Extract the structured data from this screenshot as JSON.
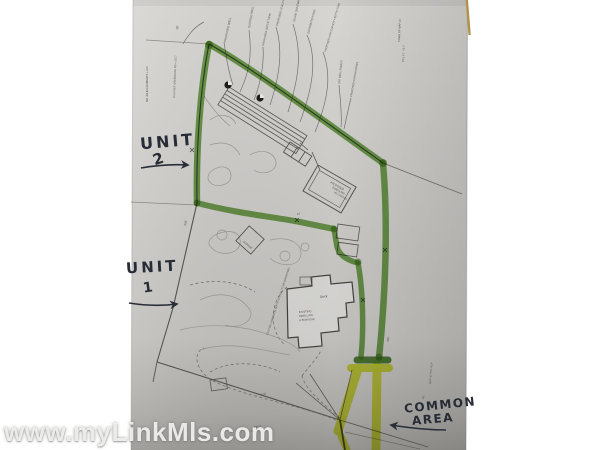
{
  "watermark": {
    "text": "www.myLinkMls.com"
  },
  "annotations": {
    "unit2": {
      "word": "UNIT",
      "number": "2"
    },
    "unit1": {
      "word": "UNIT",
      "number": "1"
    },
    "common": {
      "line1": "COMMON",
      "line2": "AREA"
    }
  },
  "colors": {
    "highlight_green": "#5f9e33",
    "highlight_yellow": "#dde93d",
    "paper": "#c9c8c5",
    "handwriting_ink": "#262b35",
    "survey_line": "#55534f",
    "paper_edge_gold": "#b2924a"
  },
  "map_labels": [
    {
      "t": "10'",
      "x": 178,
      "y": 30,
      "r": -80,
      "s": 3.2
    },
    {
      "t": "N/F JOHN A ROBERTS + CO",
      "x": 148,
      "y": 102,
      "r": -90,
      "s": 2.7
    },
    {
      "t": "PLAN REF. GREENBUSH RD = 133.7",
      "x": 175,
      "y": 98,
      "r": -88,
      "s": 2.5
    },
    {
      "t": "PROPOSED WELL",
      "x": 226,
      "y": 42,
      "r": -78,
      "s": 2.9
    },
    {
      "t": "EXISTING WELL",
      "x": 250,
      "y": 28,
      "r": -80,
      "s": 2.9
    },
    {
      "t": "PROPOSED SEPTIC TANK",
      "x": 264,
      "y": 46,
      "r": -78,
      "s": 2.7
    },
    {
      "t": "PROPOSED LEACH FIELD",
      "x": 278,
      "y": 26,
      "r": -76,
      "s": 2.7
    },
    {
      "t": "STONE DRIVEWAY",
      "x": 295,
      "y": 22,
      "r": -78,
      "s": 2.7
    },
    {
      "t": "DISTRIBUTION BOX",
      "x": 309,
      "y": 34,
      "r": -75,
      "s": 2.7
    },
    {
      "t": "PROPOSED HIGH CAPACITY SEPTIC TANK",
      "x": 326,
      "y": 52,
      "r": -74,
      "s": 2.5
    },
    {
      "t": "100' WELL RADIUS",
      "x": 340,
      "y": 84,
      "r": -84,
      "s": 2.7
    },
    {
      "t": "PROPOSED CURTAIN DRAIN",
      "x": 352,
      "y": 97,
      "r": -80,
      "s": 2.6
    },
    {
      "t": "TOWN OF MAP 41",
      "x": 400,
      "y": 42,
      "r": -88,
      "s": 2.7
    },
    {
      "t": "PCL 41 - 41.4",
      "x": 404,
      "y": 62,
      "r": -88,
      "s": 2.7
    },
    {
      "t": "434'",
      "x": 186,
      "y": 226,
      "r": -80,
      "s": 3.1
    },
    {
      "t": "14'",
      "x": 297,
      "y": 215,
      "r": -10,
      "s": 2.7
    },
    {
      "t": "435'",
      "x": 389,
      "y": 342,
      "r": -88,
      "s": 2.9
    },
    {
      "t": "4139",
      "x": 260,
      "y": 396,
      "r": -14,
      "s": 2.9
    },
    {
      "t": "MAP 41 PCL 41.4",
      "x": 431,
      "y": 384,
      "r": -86,
      "s": 2.7
    },
    {
      "t": "Deck",
      "x": 320,
      "y": 298,
      "r": -6,
      "s": 3.3
    },
    {
      "t": "PROPOSED",
      "x": 330,
      "y": 183,
      "r": 29,
      "s": 2.7
    },
    {
      "t": "DWELLING",
      "x": 332,
      "y": 188,
      "r": 29,
      "s": 2.7
    },
    {
      "t": "W/ GARAGE",
      "x": 334,
      "y": 193,
      "r": 29,
      "s": 2.5
    },
    {
      "t": "GARAGE",
      "x": 243,
      "y": 242,
      "r": 41,
      "s": 2.6
    },
    {
      "t": "EXISTING",
      "x": 299,
      "y": 313,
      "r": -4,
      "s": 2.7
    },
    {
      "t": "DWELLING",
      "x": 299,
      "y": 317,
      "r": -4,
      "s": 2.7
    },
    {
      "t": "(4 BEDROOM)",
      "x": 299,
      "y": 321,
      "r": -4,
      "s": 2.4
    },
    {
      "t": "EXISTING 4 BEDROOM SEPTIC SYSTEM (TO BE ABANDONED)",
      "x": 268,
      "y": 335,
      "r": -72,
      "s": 2.4
    },
    {
      "t": "#2",
      "x": 424,
      "y": 399,
      "r": -85,
      "s": 2.9
    },
    {
      "t": "EXIST",
      "x": 254,
      "y": 428,
      "r": -6,
      "s": 2.7
    },
    {
      "t": "DW",
      "x": 251,
      "y": 432,
      "r": -6,
      "s": 2.7
    }
  ]
}
